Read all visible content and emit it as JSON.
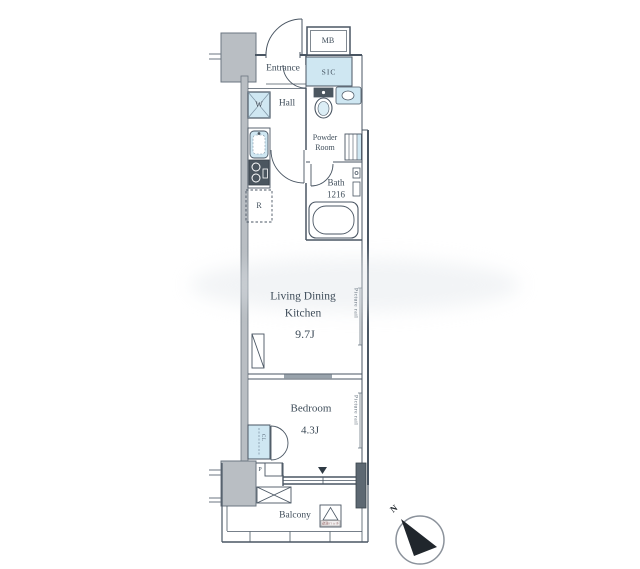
{
  "floorplan": {
    "rooms": {
      "mb": "MB",
      "entrance": "Entrance",
      "sic": "SIC",
      "hall": "Hall",
      "washer": "W",
      "powder_line1": "Powder",
      "powder_line2": "Room",
      "bath_name": "Bath",
      "bath_size": "1216",
      "fridge": "R",
      "ldk_line1": "Living Dining",
      "ldk_line2": "Kitchen",
      "ldk_size": "9.7J",
      "bedroom_name": "Bedroom",
      "bedroom_size": "4.3J",
      "closet": "CL",
      "pipe": "P",
      "balcony": "Balcony"
    },
    "annotations": {
      "picture_rail_ldk": "Picture rail",
      "picture_rail_bedroom": "Picture rail",
      "evacuation_hatch": "避難ハッチ",
      "north": "N"
    },
    "colors": {
      "wall_line": "#4a5663",
      "text": "#3f4d5a",
      "fixture_blue": "#cfe7f2",
      "pillar_gray": "#b9bec3",
      "dark_fill": "#4b565f"
    }
  }
}
